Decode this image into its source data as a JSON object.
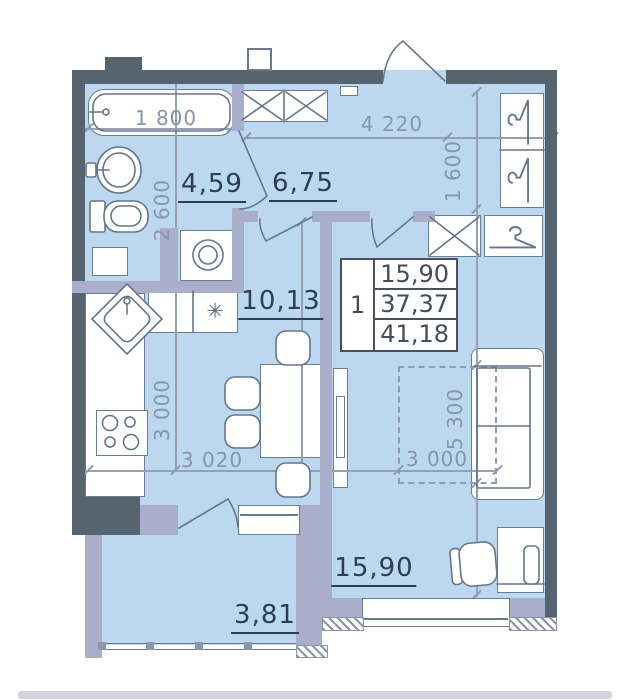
{
  "plan": {
    "rooms": [
      {
        "id": "bathroom",
        "area_label": "4,59"
      },
      {
        "id": "hallway",
        "area_label": "6,75"
      },
      {
        "id": "kitchen",
        "area_label": "10,13"
      },
      {
        "id": "living-room",
        "area_label": "15,90"
      },
      {
        "id": "balcony",
        "area_label": "3,81"
      }
    ],
    "dimensions": {
      "bathtub_length": "1 800",
      "bathroom_depth": "2 600",
      "hall_width": "4 220",
      "closet_depth": "1 600",
      "kitchen_depth": "3 000",
      "kitchen_width": "3 020",
      "living_width": "3 000",
      "living_depth": "5 300"
    },
    "stamp": {
      "rooms_count": "1",
      "living_area": "15,90",
      "apartment_area": "37,37",
      "total_area": "41,18"
    },
    "icons": {
      "hob_symbol": "✳"
    },
    "colors": {
      "floor": "#bcd8f0",
      "wall_dark": "#55646f",
      "wall_light": "#a9aecb",
      "furniture_line": "#6a7c91",
      "label_text": "#2d3d55",
      "dimension_text": "#8795aa"
    }
  }
}
